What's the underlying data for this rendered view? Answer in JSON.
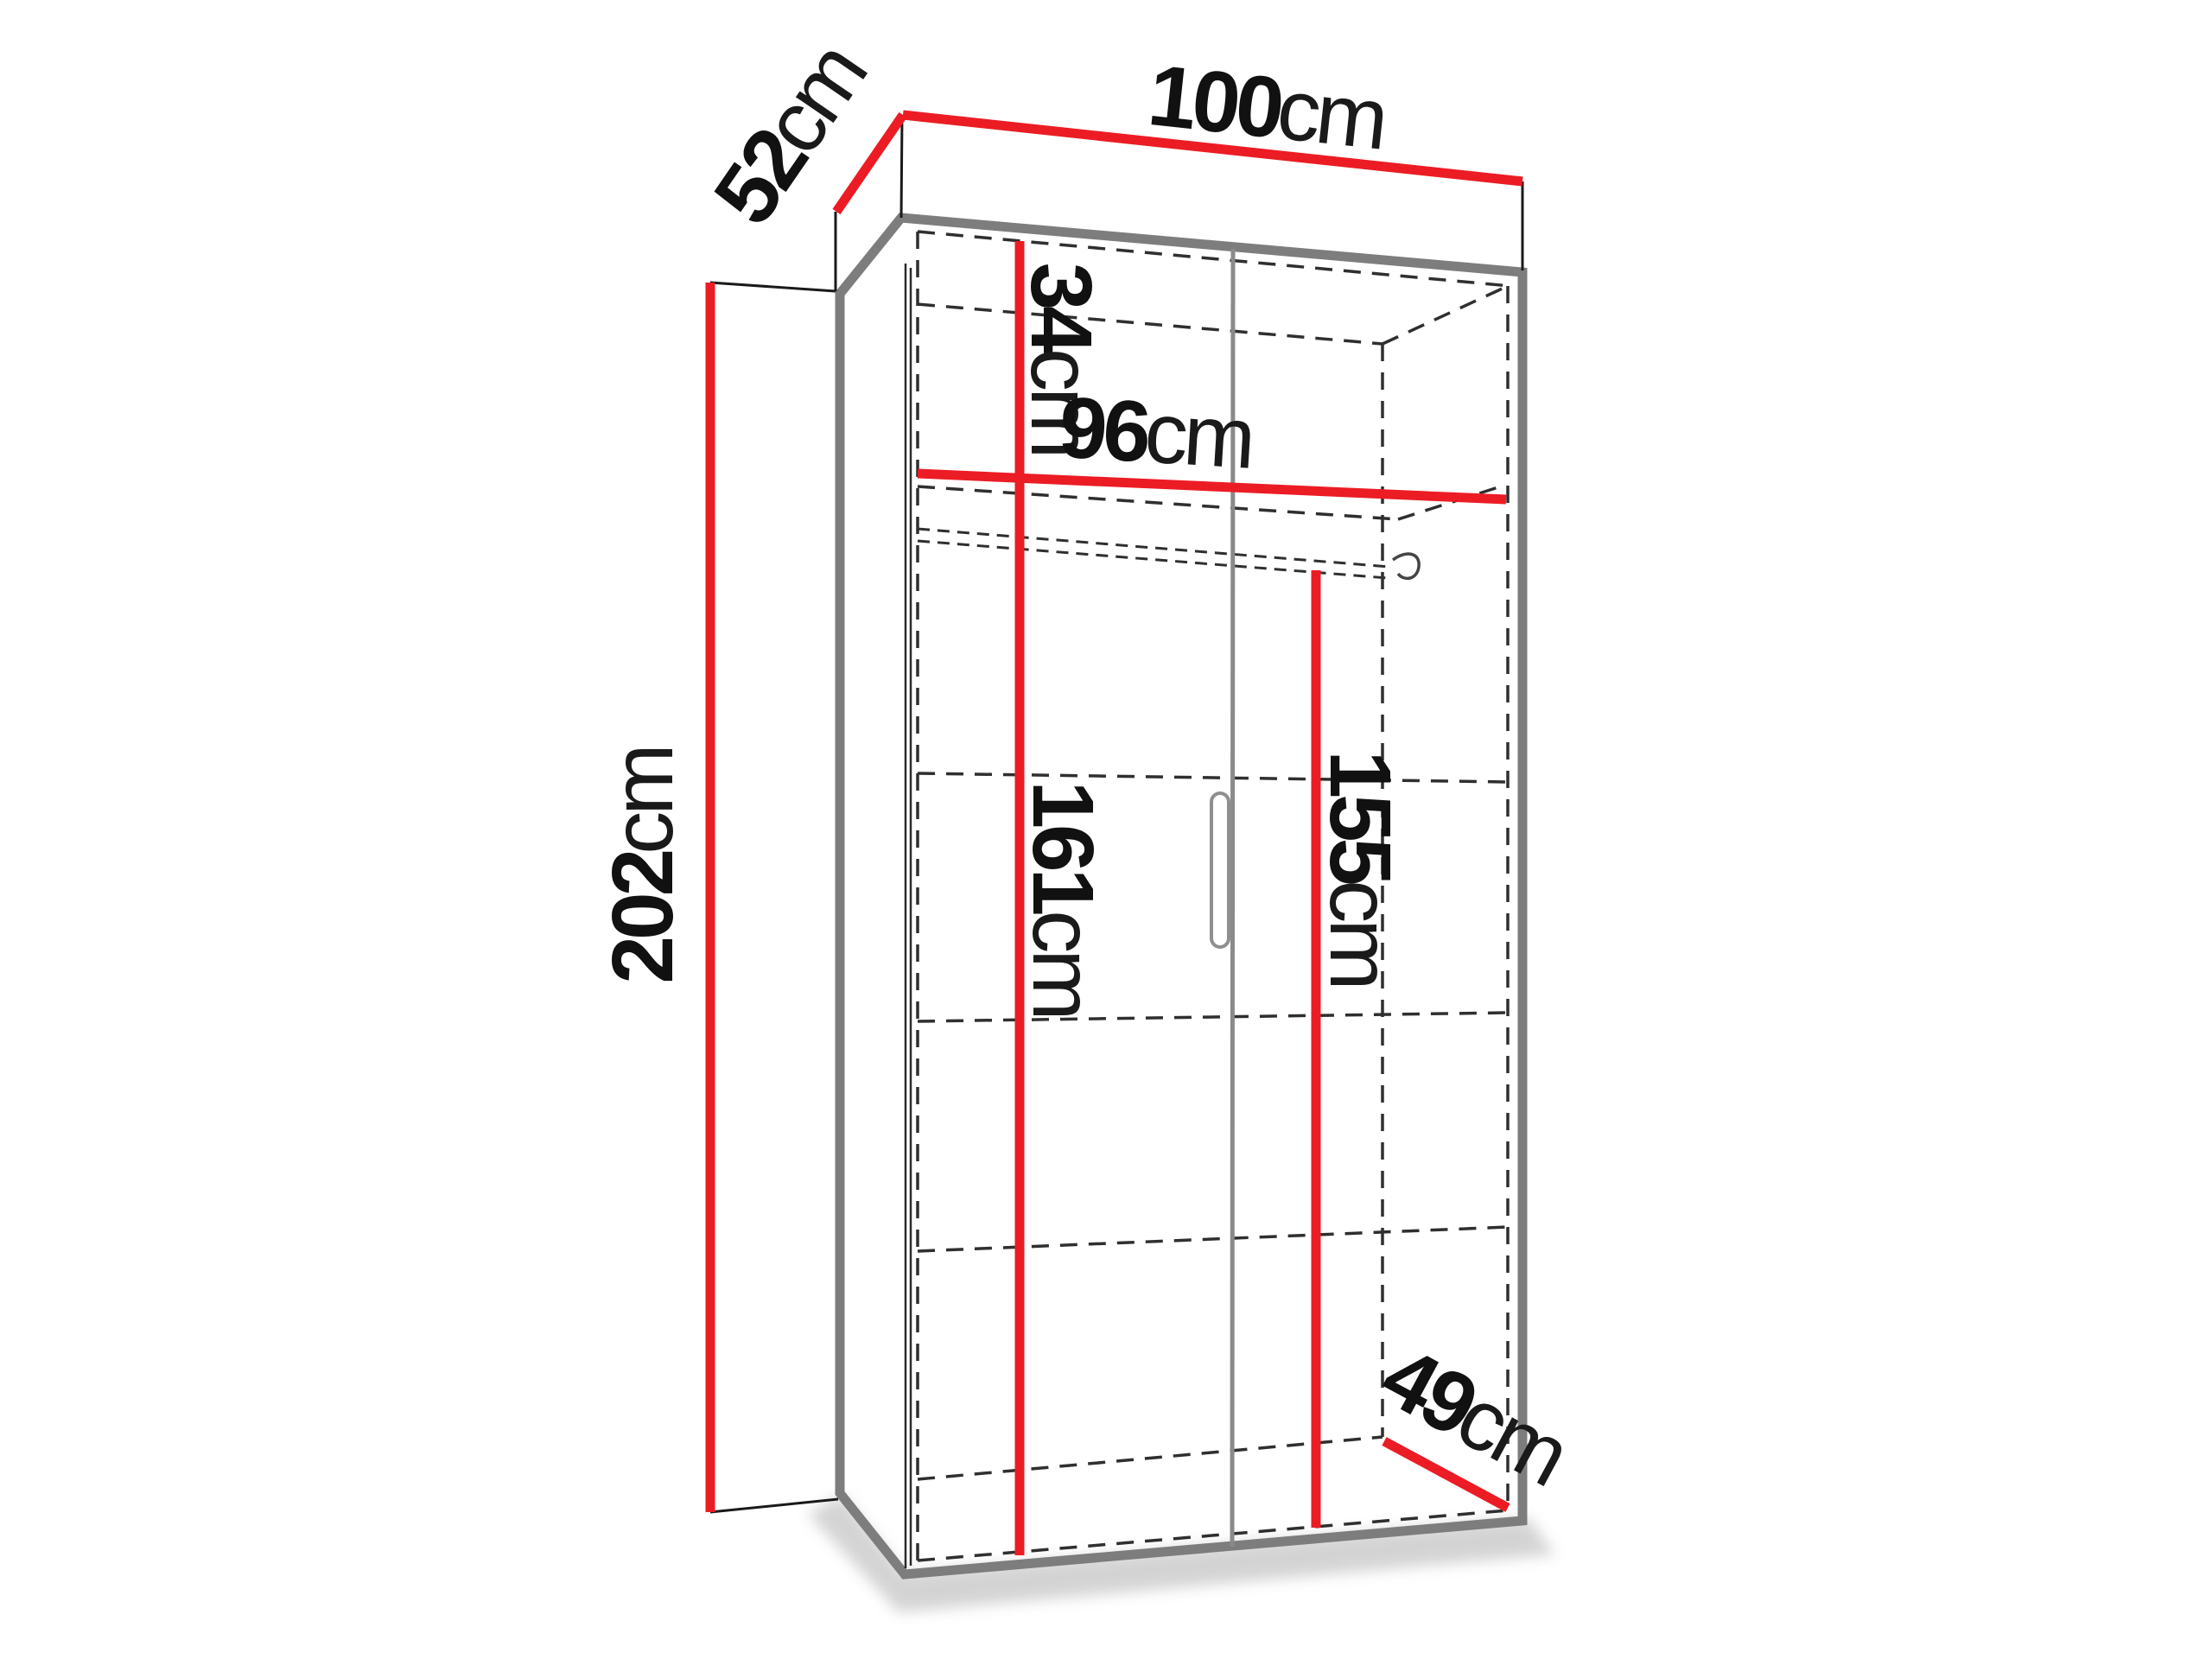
{
  "title": "Wardrobe dimension diagram",
  "unit": "cm",
  "colors": {
    "dimension_line": "#ec1c24",
    "frame_edge": "#7d7d7d",
    "hidden_line": "#2f2f2f",
    "label_text": "#111111",
    "background": "#ffffff"
  },
  "labels": {
    "overall_width": {
      "value": "100",
      "unit": "cm"
    },
    "overall_depth": {
      "value": "52",
      "unit": "cm"
    },
    "overall_height": {
      "value": "202",
      "unit": "cm"
    },
    "top_section_height": {
      "value": "34",
      "unit": "cm"
    },
    "interior_width": {
      "value": "96",
      "unit": "cm"
    },
    "interior_height_left": {
      "value": "161",
      "unit": "cm"
    },
    "hanging_height": {
      "value": "155",
      "unit": "cm"
    },
    "interior_depth": {
      "value": "49",
      "unit": "cm"
    }
  }
}
